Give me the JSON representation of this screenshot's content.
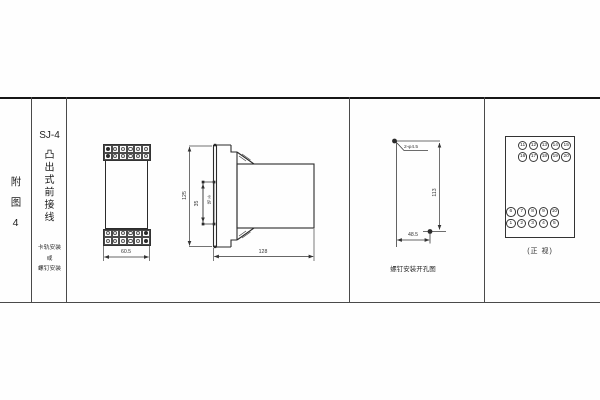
{
  "sidebar": {
    "figure_label": "附图4",
    "model": "SJ-4",
    "mount_type": "凸出式前接线",
    "note_line1": "卡轨安装",
    "note_line2": "或",
    "note_line3": "螺钉安装"
  },
  "front_view": {
    "width_dim": "60.5"
  },
  "side_view": {
    "height_dim": "125",
    "rail_width_dim": "35",
    "rail_label": "卡轨",
    "depth_dim": "128"
  },
  "drill_view": {
    "holes_label": "2-φ4.5",
    "height_dim": "113",
    "width_dim": "48.5",
    "caption": "螺钉安装开孔图"
  },
  "terminal_view": {
    "caption": "(正 视)",
    "top_row_1": [
      "11",
      "12",
      "13",
      "14",
      "15"
    ],
    "top_row_2": [
      "16",
      "17",
      "18",
      "19",
      "20"
    ],
    "bottom_row_1": [
      "6",
      "7",
      "8",
      "9",
      "10"
    ],
    "bottom_row_2": [
      "1",
      "2",
      "3",
      "4",
      "5"
    ]
  }
}
